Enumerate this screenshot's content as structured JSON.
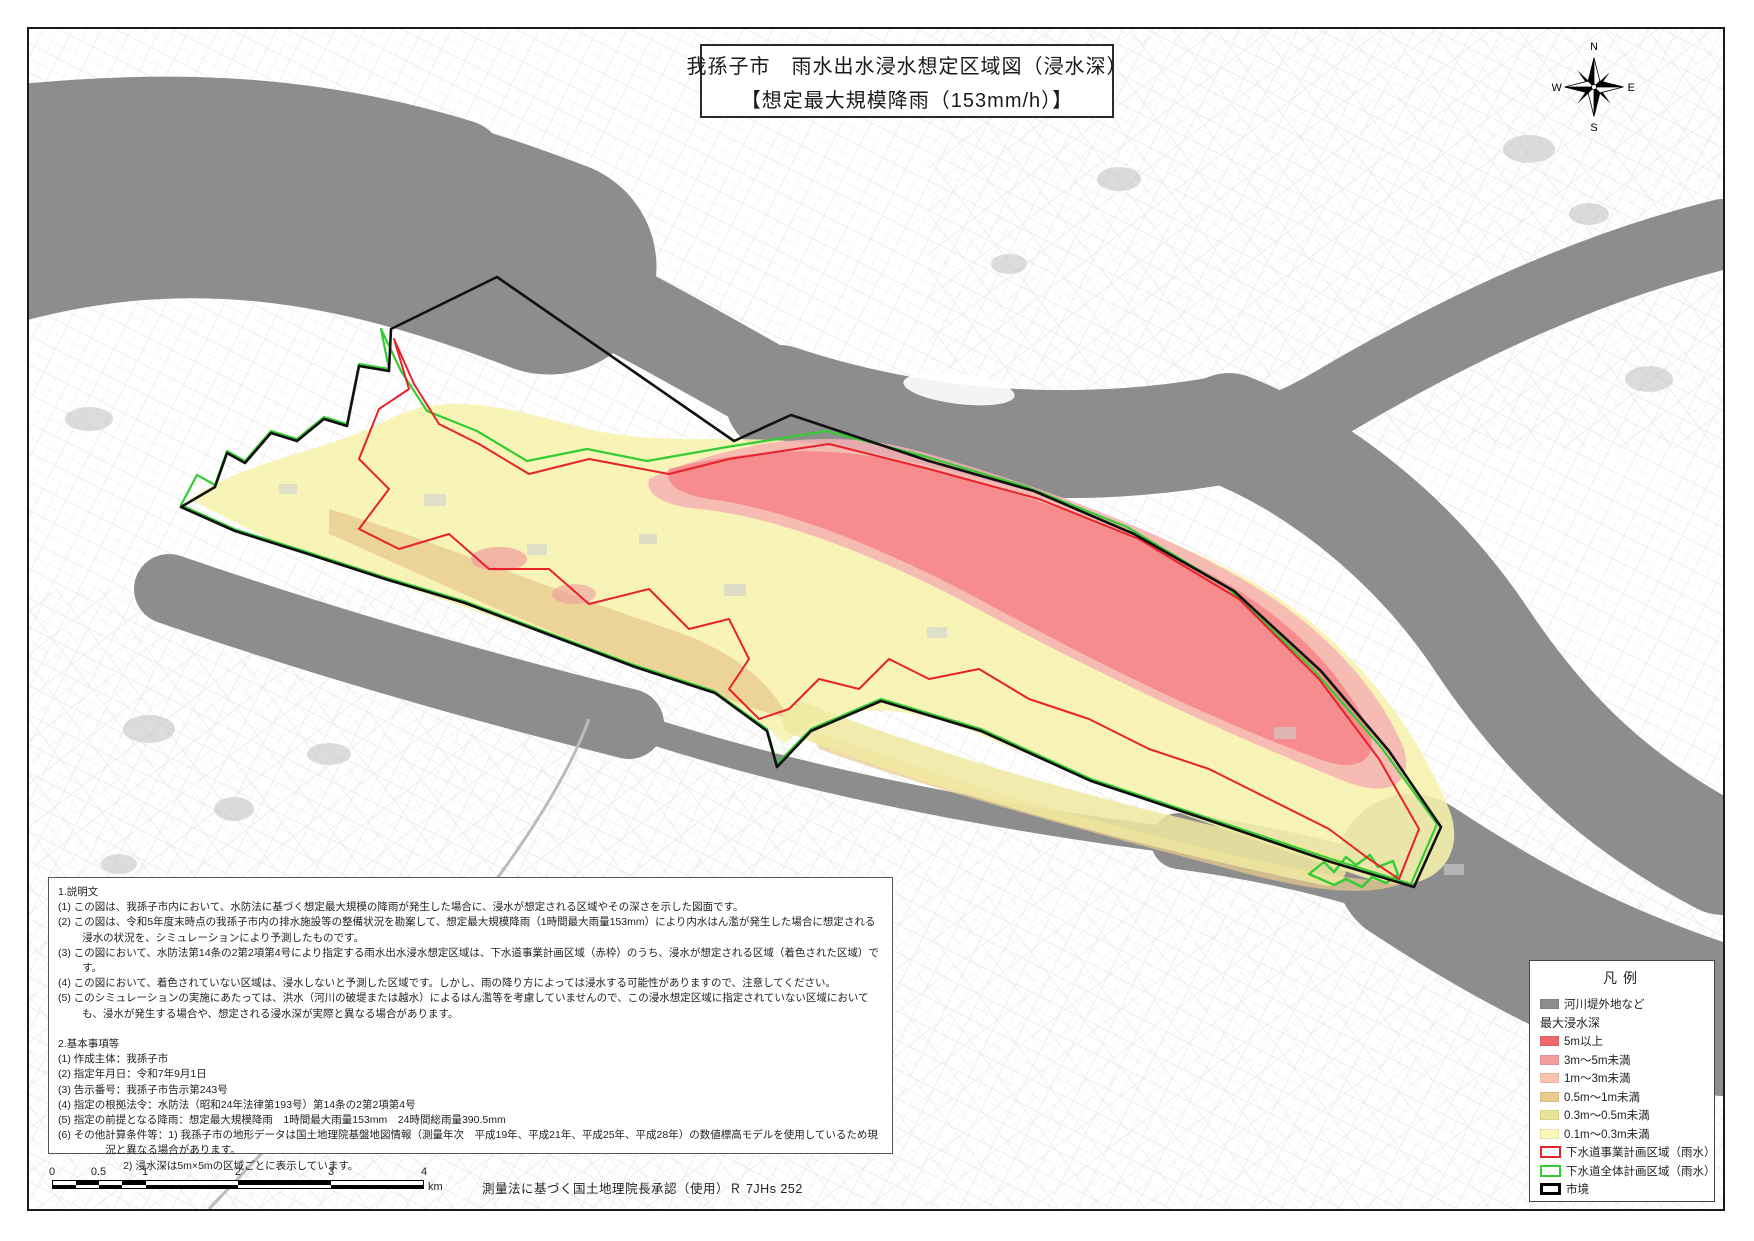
{
  "title": {
    "line1": "我孫子市　雨水出水浸水想定区域図（浸水深）",
    "line2": "【想定最大規模降雨（153mm/h）】"
  },
  "compass": {
    "north": "N",
    "east": "E",
    "south": "S",
    "west": "W"
  },
  "notes": {
    "s1_title": "1.説明文",
    "s1": [
      "(1) この図は、我孫子市内において、水防法に基づく想定最大規模の降雨が発生した場合に、浸水が想定される区域やその深さを示した図面です。",
      "(2) この図は、令和5年度末時点の我孫子市内の排水施設等の整備状況を勘案して、想定最大規模降雨（1時間最大雨量153mm）により内水はん濫が発生した場合に想定される浸水の状況を、シミュレーションにより予測したものです。",
      "(3) この図において、水防法第14条の2第2項第4号により指定する雨水出水浸水想定区域は、下水道事業計画区域（赤枠）のうち、浸水が想定される区域（着色された区域）です。",
      "(4) この図において、着色されていない区域は、浸水しないと予測した区域です。しかし、雨の降り方によっては浸水する可能性がありますので、注意してください。",
      "(5) このシミュレーションの実施にあたっては、洪水（河川の破堤または越水）によるはん濫等を考慮していませんので、この浸水想定区域に指定されていない区域においても、浸水が発生する場合や、想定される浸水深が実際と異なる場合があります。"
    ],
    "s2_title": "2.基本事項等",
    "s2": [
      "(1) 作成主体：我孫子市",
      "(2) 指定年月日：令和7年9月1日",
      "(3) 告示番号：我孫子市告示第243号",
      "(4) 指定の根拠法令：水防法（昭和24年法律第193号）第14条の2第2項第4号",
      "(5) 指定の前提となる降雨：想定最大規模降雨　1時間最大雨量153mm　24時間総雨量390.5mm",
      "(6) その他計算条件等：1) 我孫子市の地形データは国土地理院基盤地図情報（測量年次　平成19年、平成21年、平成25年、平成28年）の数値標高モデルを使用しているため現況と異なる場合があります。",
      "2) 浸水深は5m×5mの区域ごとに表示しています。"
    ]
  },
  "scalebar": {
    "t0": "0",
    "t05": "0.5",
    "t1": "1",
    "t2": "2",
    "t3": "3",
    "t4": "4",
    "unit": "km"
  },
  "approval": "測量法に基づく国土地理院長承認（使用）Ｒ 7JHs 252",
  "legend": {
    "title": "凡例",
    "river_label": "河川堤外地など",
    "river_color": "#8d8d8d",
    "depth_header": "最大浸水深",
    "items": [
      {
        "label": "5m以上",
        "color": "#ee686b"
      },
      {
        "label": "3m〜5m未満",
        "color": "#f49c9e"
      },
      {
        "label": "1m〜3m未満",
        "color": "#f6c3af"
      },
      {
        "label": "0.5m〜1m未満",
        "color": "#e9cb90"
      },
      {
        "label": "0.3m〜0.5m未満",
        "color": "#eae596"
      },
      {
        "label": "0.1m〜0.3m未満",
        "color": "#faf7b8"
      }
    ],
    "outline_items": [
      {
        "label": "下水道事業計画区域（雨水）",
        "color": "#e8222a"
      },
      {
        "label": "下水道全体計画区域（雨水）",
        "color": "#33cc33"
      },
      {
        "label": "市境",
        "color": "#000000"
      }
    ]
  }
}
